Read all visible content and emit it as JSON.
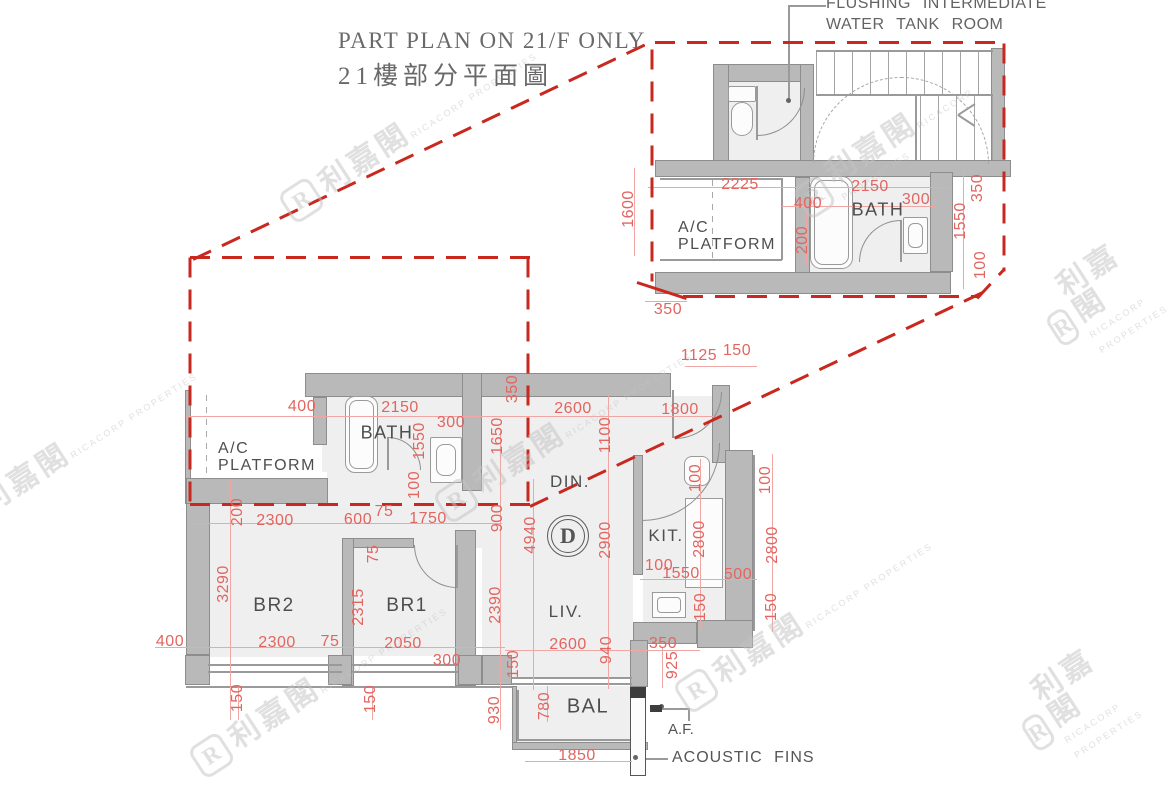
{
  "title": {
    "en": "PART PLAN ON 21/F ONLY",
    "zh": "21樓部分平面圖"
  },
  "annotations": {
    "tank_line1": "FLUSHING  INTERMEDIATE",
    "tank_line2": "WATER  TANK  ROOM",
    "af": "A.F.",
    "acoustic_fins": "ACOUSTIC  FINS"
  },
  "unit_badge": "D",
  "colors": {
    "dimension": "#e26560",
    "callout_red": "#c8281e",
    "wall": "#b9b9b9",
    "label": "#4e4e4e"
  },
  "watermark": {
    "cn": "利嘉閣",
    "en": "RICACORP PROPERTIES",
    "logo": "R",
    "positions": [
      [
        410,
        130
      ],
      [
        910,
        135
      ],
      [
        70,
        450
      ],
      [
        565,
        430
      ],
      [
        1105,
        300
      ],
      [
        320,
        685
      ],
      [
        805,
        620
      ],
      [
        1080,
        705
      ]
    ]
  },
  "rooms": [
    {
      "label": "A/C\nPLATFORM",
      "x": 678,
      "y": 220,
      "size": 16,
      "align": "left"
    },
    {
      "label": "BATH",
      "x": 878,
      "y": 210,
      "size": 18,
      "align": "center"
    },
    {
      "label": "A/C\nPLATFORM",
      "x": 218,
      "y": 441,
      "size": 16,
      "align": "left"
    },
    {
      "label": "BATH",
      "x": 387,
      "y": 433,
      "size": 18,
      "align": "center"
    },
    {
      "label": "DIN.",
      "x": 570,
      "y": 482,
      "size": 17,
      "align": "center"
    },
    {
      "label": "LIV.",
      "x": 566,
      "y": 612,
      "size": 17,
      "align": "center"
    },
    {
      "label": "KIT.",
      "x": 666,
      "y": 536,
      "size": 17,
      "align": "center"
    },
    {
      "label": "BR2",
      "x": 274,
      "y": 606,
      "size": 19,
      "align": "center"
    },
    {
      "label": "BR1",
      "x": 407,
      "y": 606,
      "size": 19,
      "align": "center"
    },
    {
      "label": "BAL",
      "x": 588,
      "y": 707,
      "size": 20,
      "align": "center"
    }
  ],
  "dimensions": [
    {
      "t": "2225",
      "x": 740,
      "y": 185,
      "v": 0
    },
    {
      "t": "2150",
      "x": 870,
      "y": 187,
      "v": 0
    },
    {
      "t": "400",
      "x": 808,
      "y": 204,
      "v": 0
    },
    {
      "t": "300",
      "x": 916,
      "y": 200,
      "v": 0
    },
    {
      "t": "1600",
      "x": 629,
      "y": 209,
      "v": 1
    },
    {
      "t": "200",
      "x": 803,
      "y": 240,
      "v": 1
    },
    {
      "t": "350",
      "x": 668,
      "y": 310,
      "v": 0
    },
    {
      "t": "350",
      "x": 978,
      "y": 188,
      "v": 1
    },
    {
      "t": "1550",
      "x": 961,
      "y": 221,
      "v": 1
    },
    {
      "t": "100",
      "x": 981,
      "y": 265,
      "v": 1
    },
    {
      "t": "400",
      "x": 302,
      "y": 407,
      "v": 0
    },
    {
      "t": "2150",
      "x": 400,
      "y": 408,
      "v": 0
    },
    {
      "t": "300",
      "x": 451,
      "y": 423,
      "v": 0
    },
    {
      "t": "350",
      "x": 513,
      "y": 389,
      "v": 1
    },
    {
      "t": "1550",
      "x": 420,
      "y": 441,
      "v": 1
    },
    {
      "t": "1650",
      "x": 498,
      "y": 436,
      "v": 1
    },
    {
      "t": "2600",
      "x": 573,
      "y": 409,
      "v": 0
    },
    {
      "t": "1800",
      "x": 680,
      "y": 410,
      "v": 0
    },
    {
      "t": "1125",
      "x": 699,
      "y": 356,
      "v": 0
    },
    {
      "t": "150",
      "x": 737,
      "y": 351,
      "v": 0
    },
    {
      "t": "1100",
      "x": 606,
      "y": 435,
      "v": 1
    },
    {
      "t": "100",
      "x": 415,
      "y": 485,
      "v": 1
    },
    {
      "t": "900",
      "x": 498,
      "y": 518,
      "v": 1
    },
    {
      "t": "4940",
      "x": 531,
      "y": 535,
      "v": 1
    },
    {
      "t": "2900",
      "x": 606,
      "y": 540,
      "v": 1
    },
    {
      "t": "100",
      "x": 696,
      "y": 478,
      "v": 1
    },
    {
      "t": "2800",
      "x": 700,
      "y": 539,
      "v": 1
    },
    {
      "t": "150",
      "x": 701,
      "y": 607,
      "v": 1
    },
    {
      "t": "100",
      "x": 766,
      "y": 480,
      "v": 1
    },
    {
      "t": "2800",
      "x": 773,
      "y": 545,
      "v": 1
    },
    {
      "t": "150",
      "x": 772,
      "y": 607,
      "v": 1
    },
    {
      "t": "100",
      "x": 659,
      "y": 566,
      "v": 0
    },
    {
      "t": "1550",
      "x": 681,
      "y": 574,
      "v": 0
    },
    {
      "t": "500",
      "x": 738,
      "y": 575,
      "v": 0
    },
    {
      "t": "200",
      "x": 238,
      "y": 512,
      "v": 1
    },
    {
      "t": "2300",
      "x": 275,
      "y": 521,
      "v": 0
    },
    {
      "t": "600",
      "x": 358,
      "y": 520,
      "v": 0
    },
    {
      "t": "75",
      "x": 384,
      "y": 512,
      "v": 0
    },
    {
      "t": "1750",
      "x": 428,
      "y": 519,
      "v": 0
    },
    {
      "t": "75",
      "x": 374,
      "y": 554,
      "v": 1
    },
    {
      "t": "3290",
      "x": 224,
      "y": 584,
      "v": 1
    },
    {
      "t": "2315",
      "x": 359,
      "y": 607,
      "v": 1
    },
    {
      "t": "2390",
      "x": 496,
      "y": 605,
      "v": 1
    },
    {
      "t": "400",
      "x": 170,
      "y": 642,
      "v": 0
    },
    {
      "t": "2300",
      "x": 277,
      "y": 643,
      "v": 0
    },
    {
      "t": "75",
      "x": 330,
      "y": 642,
      "v": 0
    },
    {
      "t": "2050",
      "x": 403,
      "y": 644,
      "v": 0
    },
    {
      "t": "300",
      "x": 447,
      "y": 661,
      "v": 0
    },
    {
      "t": "150",
      "x": 238,
      "y": 698,
      "v": 1
    },
    {
      "t": "150",
      "x": 371,
      "y": 699,
      "v": 1
    },
    {
      "t": "930",
      "x": 495,
      "y": 710,
      "v": 1
    },
    {
      "t": "2600",
      "x": 568,
      "y": 645,
      "v": 0
    },
    {
      "t": "940",
      "x": 607,
      "y": 650,
      "v": 1
    },
    {
      "t": "150",
      "x": 514,
      "y": 664,
      "v": 1
    },
    {
      "t": "350",
      "x": 663,
      "y": 644,
      "v": 0
    },
    {
      "t": "925",
      "x": 673,
      "y": 665,
      "v": 1
    },
    {
      "t": "780",
      "x": 545,
      "y": 706,
      "v": 1
    },
    {
      "t": "1850",
      "x": 577,
      "y": 756,
      "v": 0
    }
  ]
}
